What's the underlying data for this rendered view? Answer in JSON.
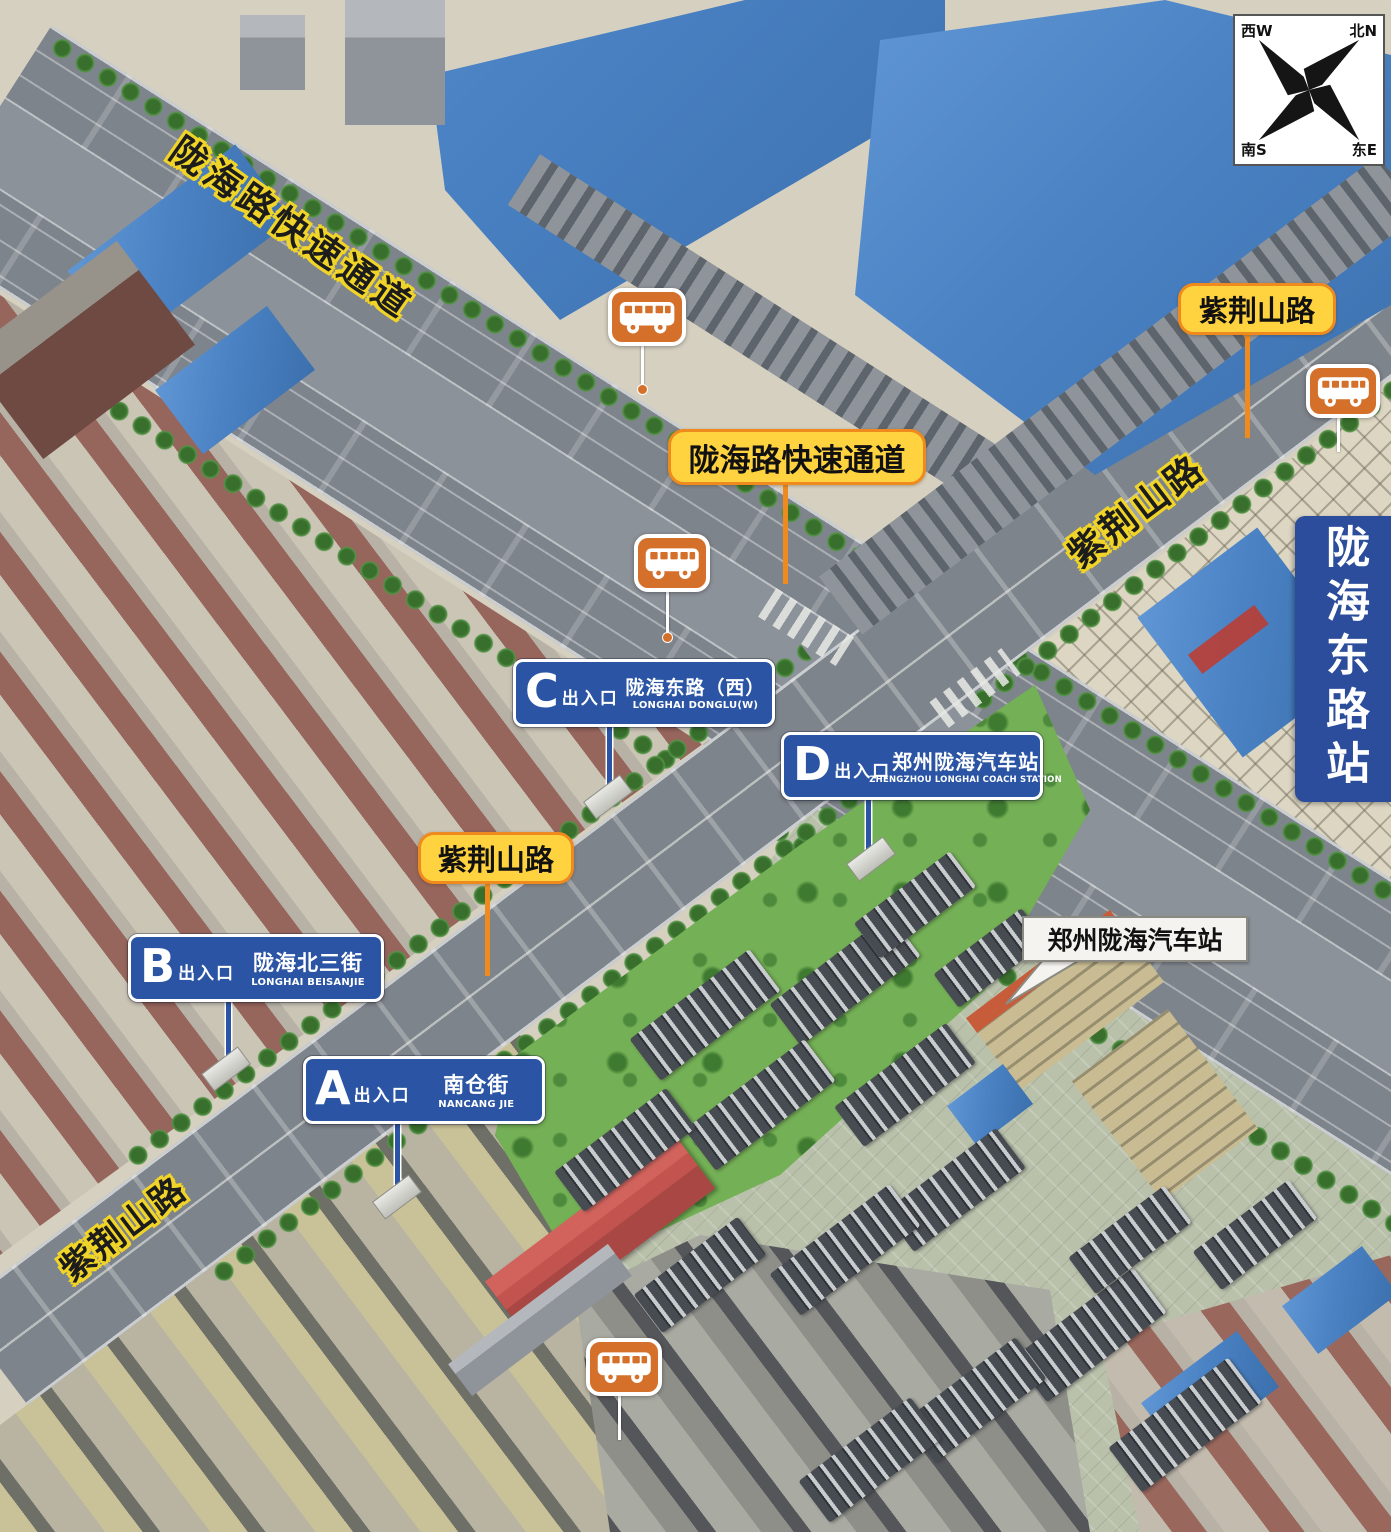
{
  "station": {
    "banner": "陇海东路站"
  },
  "compass": {
    "nw": "西W",
    "ne": "北N",
    "sw": "南S",
    "se": "东E"
  },
  "road_surface_labels": {
    "expressway_nw": "陇海路快速通道",
    "zijingshan_ne": "紫荆山路",
    "zijingshan_sw": "紫荆山路"
  },
  "callouts": {
    "expressway_center": "陇海路快速通道",
    "zijingshan_top_right": "紫荆山路",
    "zijingshan_left": "紫荆山路",
    "coach_station": "郑州陇海汽车站"
  },
  "exits": [
    {
      "letter": "A",
      "label": "出入口",
      "name": "南仓街",
      "roman": "NANCANG JIE"
    },
    {
      "letter": "B",
      "label": "出入口",
      "name": "陇海北三街",
      "roman": "LONGHAI BEISANJIE"
    },
    {
      "letter": "C",
      "label": "出入口",
      "name": "陇海东路（西）",
      "roman": "LONGHAI DONGLU(W)"
    },
    {
      "letter": "D",
      "label": "出入口",
      "name": "郑州陇海汽车站",
      "roman": "ZHENGZHOU LONGHAI COACH STATION"
    }
  ],
  "icons": {
    "bus_stop": "bus-stop-icon",
    "compass_rose": "compass-rose-icon"
  },
  "colors": {
    "callout_bg": "#FFD23F",
    "callout_border": "#EE8A1E",
    "exit_sign_bg": "#2B55A4",
    "banner_bg": "#2B4D9B",
    "bus_icon_bg": "#D4702A",
    "road_text_halo": "#F0D428",
    "road_gray": "#7E848B",
    "lawn_green": "#74B055",
    "factory_roof_blue": "#4A82C4"
  }
}
